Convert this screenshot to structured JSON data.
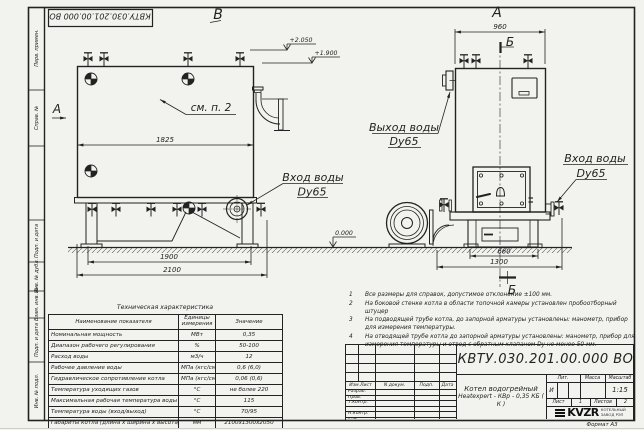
{
  "frame": {
    "stamp_top": "КВТУ.030.201.00.000  ВО",
    "margin_labels": [
      "Перв. примен.",
      "Справ. №",
      "Подп. и дата",
      "Инв. № дубл.",
      "Взам. инв. №",
      "Подп. и дата",
      "Инв. № подл."
    ],
    "format_label": "Формат  А3"
  },
  "drawing": {
    "view_b_label": "В",
    "view_a_label": "А",
    "arrow_a_label": "А",
    "see_note": "см. п. 2",
    "dim_1825": "1825",
    "dim_1900": "1900",
    "dim_2100": "2100",
    "dim_960": "960",
    "dim_660": "660",
    "dim_1300": "1300",
    "elev_2050": "+2.050",
    "elev_1900": "+1.900",
    "elev_zero": "0.000",
    "section_b_top": "Б",
    "section_b_bottom": "Б",
    "inlet_side_1": "Вход воды",
    "inlet_side_2": "Dy65",
    "outlet_front_1": "Выход воды",
    "outlet_front_2": "Dy65",
    "inlet_front_1": "Вход воды",
    "inlet_front_2": "Dy65"
  },
  "notes": {
    "items": [
      {
        "num": "1",
        "text": "Все размеры для справок, допустимое отклонение ±100 мм."
      },
      {
        "num": "2",
        "text": "На боковой стенке котла в области топочной камеры установлен пробоотборный штуцер"
      },
      {
        "num": "3",
        "text": "На  подводящей трубе котла, до запорной арматуры установлены: манометр, прибор для измерения температуры."
      },
      {
        "num": "4",
        "text": "На отводящей трубе котла до запорной арматуры установлены: манометр, прибор для измерения температуры и отвод с обратным клапаном Dу не менее 50 мм."
      }
    ]
  },
  "spec_table": {
    "title": "Техническая характеристика",
    "headers": [
      "Наименование показателя",
      "Единицы измерения",
      "Значение"
    ],
    "rows": [
      [
        "Номинальная мощность",
        "МВт",
        "0,35"
      ],
      [
        "Диапазон рабочего регулирования",
        "%",
        "50-100"
      ],
      [
        "Расход воды",
        "м3/ч",
        "12"
      ],
      [
        "Рабочее давление воды",
        "МПа (кгс/см2)",
        "0,6 (6,0)"
      ],
      [
        "Гидравлическое сопротивление котла",
        "МПа (кгс/см2)",
        "0,06 (0,6)"
      ],
      [
        "Температура уходящих газов",
        "°С",
        "не более 220"
      ],
      [
        "Максимальная рабочая температура воды",
        "°С",
        "115"
      ],
      [
        "Температура воды (вход/выход)",
        "°С",
        "70/95"
      ],
      [
        "Габариты котла (длина х ширина х высота)",
        "мм",
        "2100х1300х2050"
      ]
    ]
  },
  "title_block": {
    "designation": "КВТУ.030.201.00.000  ВО",
    "doc_name_line1": "Котел водогрейный",
    "doc_name_line2": "Heatexpert - КВр - 0,35 КБ ( К )",
    "header_cells": [
      "Изм.Лист",
      "N докум.",
      "Подп.",
      "Дата"
    ],
    "sig_rows": [
      "Разраб.",
      "Пров.",
      "Т.контр.",
      "",
      "Н.контр.",
      "Утв."
    ],
    "lit_header": "Лит.",
    "lit_value": "И",
    "mass_header": "Масса",
    "scale_header": "Масштаб",
    "scale_value": "1:15",
    "sheet_label": "Лист",
    "sheet_value": "1",
    "sheets_label": "Листов",
    "sheets_value": "2",
    "logo_text": "KVZR",
    "logo_caption_1": "КОТЕЛЬНЫЙ",
    "logo_caption_2": "ЗАВОД РЭП"
  }
}
